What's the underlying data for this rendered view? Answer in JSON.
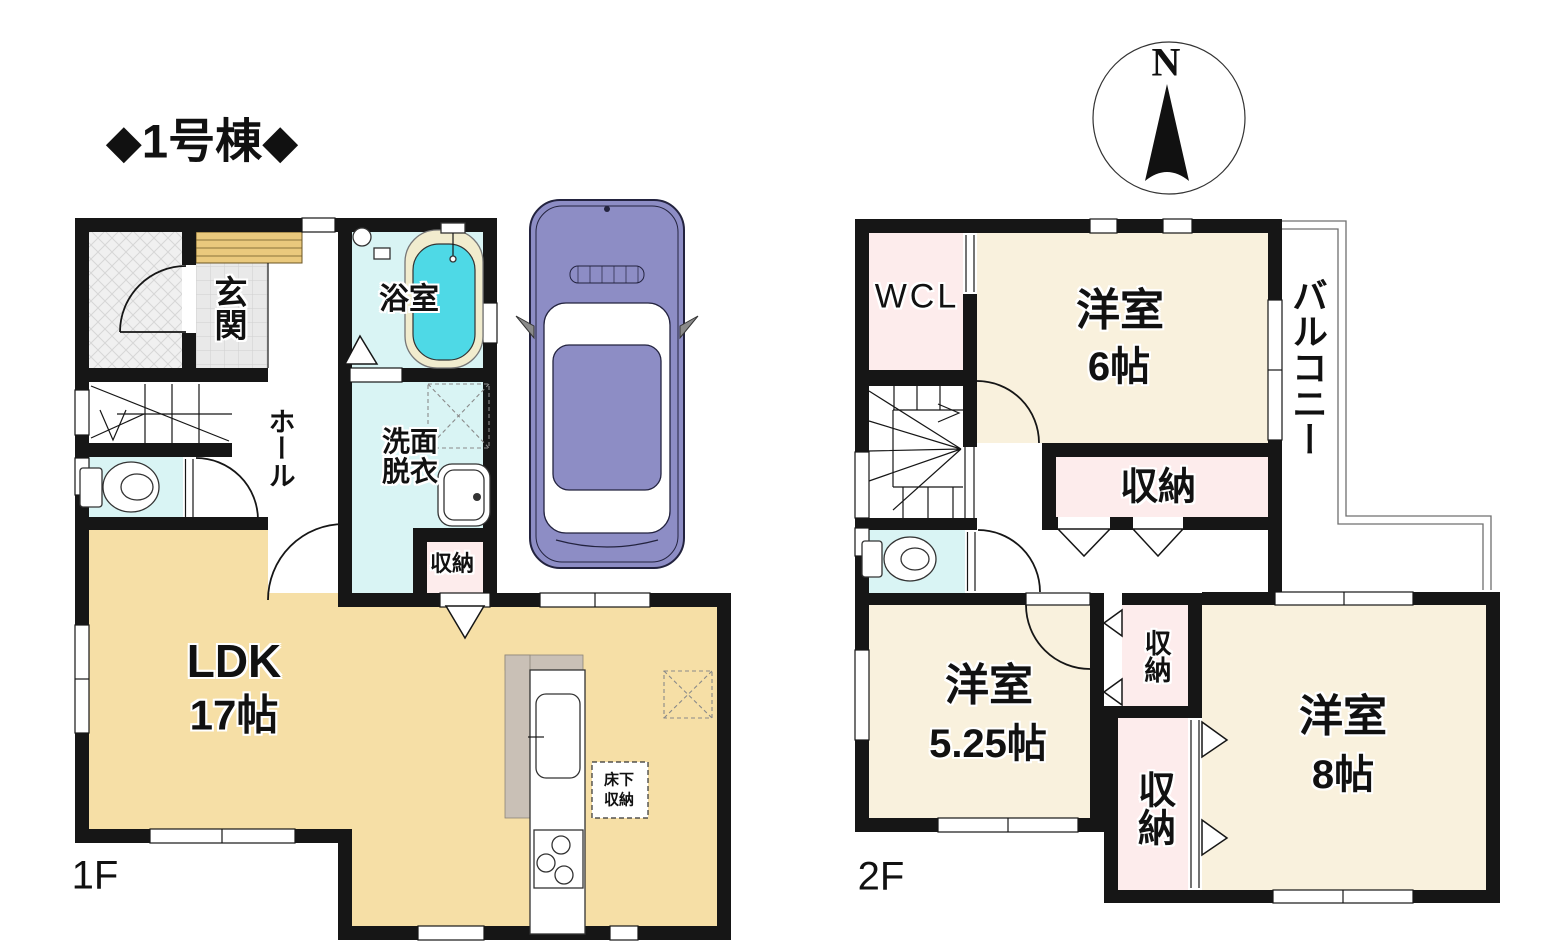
{
  "title": "◆1号棟◆",
  "compass": {
    "north": "N"
  },
  "colors": {
    "wall": "#161616",
    "ldk_fill": "#f6dfa6",
    "room_fill": "#f9f1dd",
    "closet_fill": "#fdecec",
    "water_fill": "#d9f4f4",
    "tub_fill": "#4ed9e6",
    "car_body": "#8d8dc5",
    "wood_step": "#eac97d"
  },
  "floor1": {
    "label": "1F",
    "rooms": {
      "genkan": "玄関",
      "bath": "浴室",
      "washroom_line1": "洗面",
      "washroom_line2": "脱衣",
      "hall": "ホール",
      "storage": "収納",
      "ldk": "LDK",
      "ldk_size": "17帖",
      "underfloor_line1": "床下",
      "underfloor_line2": "収納"
    }
  },
  "floor2": {
    "label": "2F",
    "rooms": {
      "wcl": "WCL",
      "bedroom6": "洋室",
      "bedroom6_size": "6帖",
      "balcony": "バルコニー",
      "storage_main": "収納",
      "bedroom525": "洋室",
      "bedroom525_size": "5.25帖",
      "storage_small": "収納",
      "storage_tall": "収納",
      "bedroom8": "洋室",
      "bedroom8_size": "8帖"
    }
  }
}
